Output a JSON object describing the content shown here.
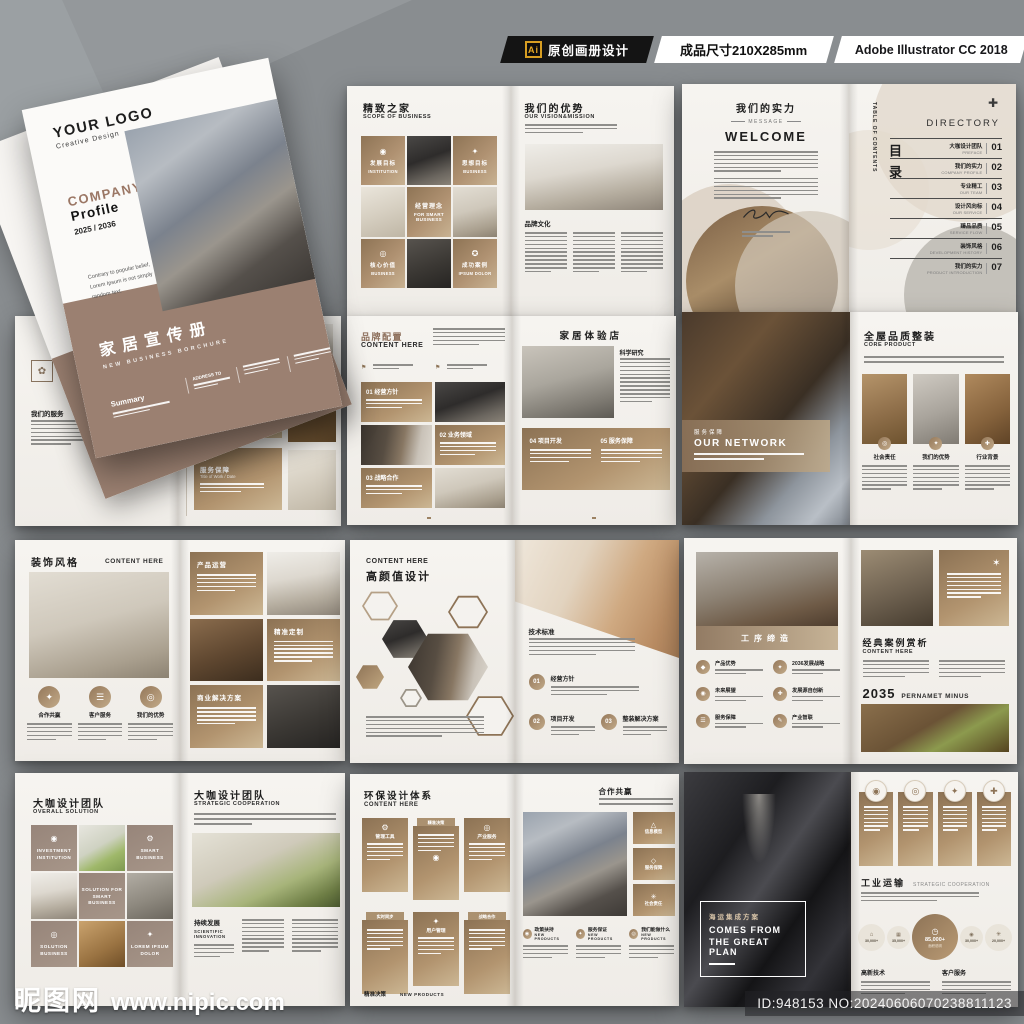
{
  "header": {
    "ai_badge": "Ai",
    "label_origin": "原创画册设计",
    "label_size": "成品尺寸210X285mm",
    "label_software": "Adobe Illustrator CC 2018"
  },
  "watermark": {
    "site_cn": "昵图网",
    "site_url": "www.nipic.com",
    "id_text": "ID:948153 NO:20240606070238811123"
  },
  "colors": {
    "accent_brown": "#9b8071",
    "tile_gradient_dark": "#8e7455",
    "tile_gradient_light": "#c8b292",
    "header_black": "#141414",
    "ai_gold": "#d79e22",
    "page_bg": "#f4f2ee",
    "canvas_gray": "#898d90"
  },
  "cover": {
    "logo": "YOUR LOGO",
    "logo_sub": "Creative Design",
    "company": "COMPANY",
    "profile": "Profile",
    "years": "2025 / 2036",
    "tagline1": "Contrary to popular belief,",
    "tagline2": "Lorem Ipsum is not simply",
    "tagline3": "random text.",
    "title_cn": "家居宣传册",
    "title_en": "NEW BUSINESS BORCHURE",
    "summary": "Summary",
    "address": "ADDRESS TO"
  },
  "back_cover": {
    "hotline": "全国热线·服务热线",
    "phone": "400-123-4567"
  },
  "spreads": {
    "s1": {
      "left": {
        "title": "精致之家",
        "subtitle": "SCOPE OF BUSINESS",
        "tiles": [
          {
            "cn": "发展目标",
            "en": "INSTITUTION"
          },
          {
            "cn": "思想目标",
            "en": "BUSINESS"
          },
          {
            "cn": "经营理念",
            "en": "FOR SMART BUSINESS"
          },
          {
            "cn": "核心价值",
            "en": "BUSINESS"
          },
          {
            "cn": "成功案例",
            "en": "IPSUM DOLOR"
          }
        ]
      },
      "right": {
        "title": "我们的优势",
        "subtitle": "OUR VISION&MISSION",
        "section": "品牌文化"
      }
    },
    "s2": {
      "left": {
        "title": "我们的实力",
        "tag": "MESSAGE",
        "welcome": "WELCOME"
      },
      "right": {
        "toc_en": "TABLE OF CONTENTS",
        "toc_cn": "目录",
        "dir": "DIRECTORY",
        "plus": "✚",
        "items": [
          {
            "num": "01",
            "cn": "大咖设计团队",
            "en": "PREFACE"
          },
          {
            "num": "02",
            "cn": "我们的实力",
            "en": "COMPANY PROFILE"
          },
          {
            "num": "03",
            "cn": "专业精工",
            "en": "OUR TEAM"
          },
          {
            "num": "04",
            "cn": "设计风向标",
            "en": "OUR SERVICE"
          },
          {
            "num": "05",
            "cn": "臻品品质",
            "en": "SERVICE FLOW"
          },
          {
            "num": "06",
            "cn": "装饰风格",
            "en": "DEVELOPMENT HISTORY"
          },
          {
            "num": "07",
            "cn": "我们的实力",
            "en": "PRODUCT INTRODUCTION"
          }
        ]
      }
    },
    "s3": {
      "left": {
        "title": "智能化运输",
        "subtitle": "PRODUCT OPERATION",
        "section": "我们的服务"
      },
      "right": {
        "cards": [
          {
            "cn": "产业智联",
            "en": "Title of Work / Date"
          },
          {
            "cn": "服务保障",
            "en": "Title of Work / Date"
          }
        ]
      }
    },
    "s4": {
      "left": {
        "title": "品牌配置",
        "subtitle": "CONTENT HERE",
        "items": [
          {
            "num": "01",
            "cn": "经营方针"
          },
          {
            "num": "02",
            "cn": "业务领域"
          },
          {
            "num": "03",
            "cn": "战略合作"
          }
        ]
      },
      "right": {
        "title": "家居体验店",
        "section": "科学研究",
        "items": [
          {
            "num": "04",
            "cn": "项目开发"
          },
          {
            "num": "05",
            "cn": "服务保障"
          }
        ]
      }
    },
    "s5": {
      "left": {
        "band_cn": "服务保障",
        "band_en": "OUR NETWORK"
      },
      "right": {
        "title": "全屋品质整装",
        "subtitle": "CORE PRODUCT",
        "cols": [
          {
            "cn": "社会责任"
          },
          {
            "cn": "我们的优势"
          },
          {
            "cn": "行业背景"
          }
        ]
      }
    },
    "s6": {
      "left": {
        "title": "装饰风格",
        "subtitle": "CONTENT HERE",
        "features": [
          {
            "cn": "合作共赢"
          },
          {
            "cn": "客户服务"
          },
          {
            "cn": "我们的优势"
          }
        ]
      },
      "right": {
        "cards": [
          {
            "cn": "产品运营"
          },
          {
            "cn": "精准定制"
          },
          {
            "cn": "商业解决方案"
          }
        ]
      }
    },
    "s7": {
      "left": {
        "subtitle": "CONTENT HERE",
        "title": "高颜值设计"
      },
      "right": {
        "section": "技术标准",
        "steps": [
          {
            "num": "01",
            "cn": "经营方针"
          },
          {
            "num": "02",
            "cn": "项目开发"
          },
          {
            "num": "03",
            "cn": "整装解决方案"
          }
        ]
      }
    },
    "s8": {
      "left": {
        "band": "工序缔造",
        "features": [
          {
            "cn": "产品优势"
          },
          {
            "cn": "2036发展战略"
          },
          {
            "cn": "未来展望"
          },
          {
            "cn": "发展源自创新"
          },
          {
            "cn": "服务保障"
          },
          {
            "cn": "产业智联"
          }
        ]
      },
      "right": {
        "title": "经典案例赏析",
        "subtitle": "CONTENT HERE",
        "year": "2035",
        "year_sub": "PERNAMET MINUS"
      }
    },
    "s9": {
      "left": {
        "title": "大咖设计团队",
        "subtitle": "OVERALL SOLUTION",
        "tiles": [
          {
            "en": "INVESTMENT INSTITUTION"
          },
          {
            "en": "SMART BUSINESS"
          },
          {
            "en": "SOLUTION FOR SMART BUSINESS"
          },
          {
            "en": "SOLUTION BUSINESS"
          },
          {
            "en": "LOREM IPSUM DOLOR"
          }
        ]
      },
      "right": {
        "title": "大咖设计团队",
        "subtitle": "STRATEGIC COOPERATION",
        "section_cn": "持续发展",
        "section_en": "SCIENTIFIC INNOVATION"
      }
    },
    "s10": {
      "left": {
        "title": "环保设计体系",
        "subtitle": "CONTENT HERE",
        "cards": [
          {
            "cn": "管理工具"
          },
          {
            "cn": "精准决策"
          },
          {
            "cn": "产业服务"
          },
          {
            "cn": "实时同步"
          },
          {
            "cn": "用户管理"
          },
          {
            "cn": "战略合作"
          }
        ],
        "footer_cn": "精准决策",
        "footer_en": "NEW PRODUCTS"
      },
      "right": {
        "title": "合作共赢",
        "cards": [
          {
            "cn": "信息模型"
          },
          {
            "cn": "服务保障"
          },
          {
            "cn": "社会责任"
          }
        ],
        "items": [
          {
            "cn": "政策扶持",
            "en": "NEW PRODUCTS"
          },
          {
            "cn": "服务保证",
            "en": "NEW PRODUCTS"
          },
          {
            "cn": "我们能做什么",
            "en": "NEW PRODUCTS"
          }
        ]
      }
    },
    "s11": {
      "left": {
        "overlay_cn": "海运集成方案",
        "overlay_en1": "COMES FROM",
        "overlay_en2": "THE GREAT PLAN"
      },
      "right": {
        "title_cn": "工业运输",
        "title_en": "STRATEGIC COOPERATION",
        "stats": [
          {
            "v": "30,000+"
          },
          {
            "v": "35,000+"
          },
          {
            "v": "85,000+",
            "sub": "面积说明"
          },
          {
            "v": "30,000+"
          },
          {
            "v": "20,000+"
          }
        ],
        "sections": [
          {
            "cn": "高新技术"
          },
          {
            "cn": "客户服务"
          }
        ]
      }
    }
  }
}
